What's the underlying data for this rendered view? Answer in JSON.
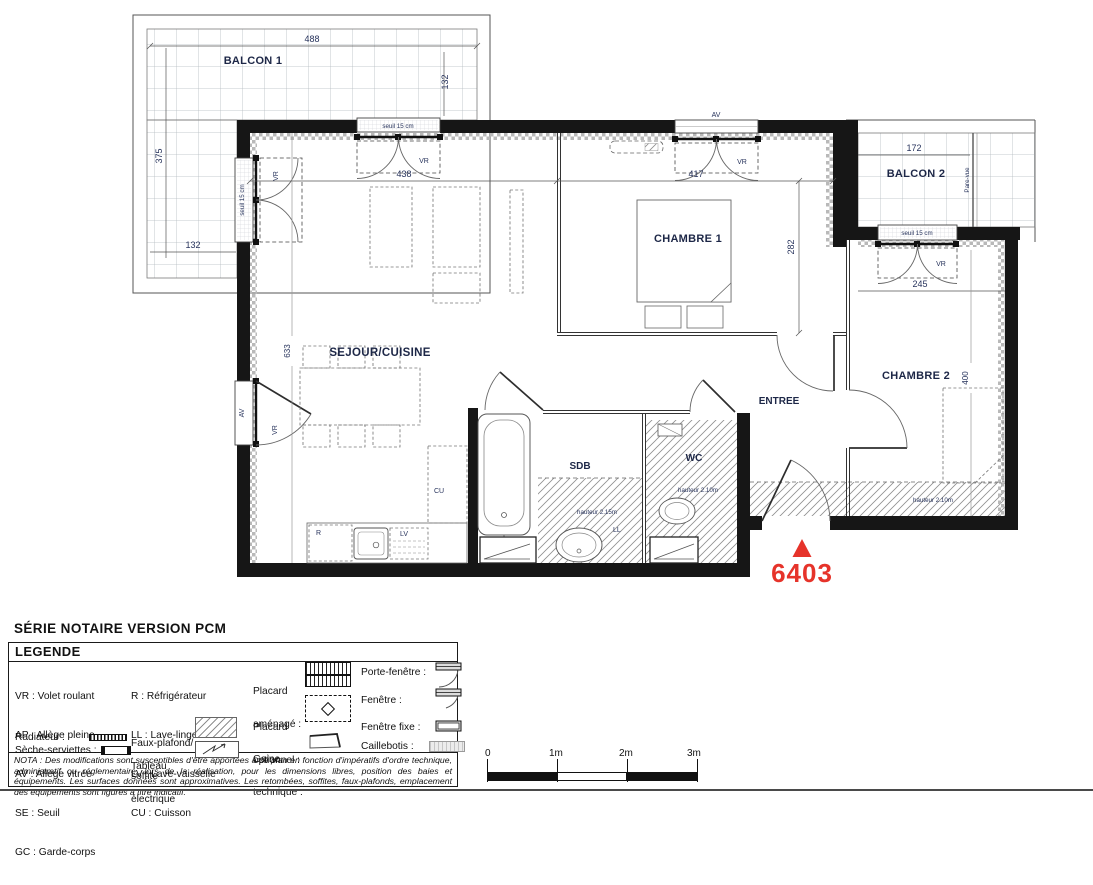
{
  "title": "SÉRIE NOTAIRE VERSION PCM",
  "plan": {
    "lot_number": "6403",
    "rooms": {
      "balcon1": "BALCON 1",
      "balcon2": "BALCON 2",
      "sejour": "SEJOUR/CUISINE",
      "chambre1": "CHAMBRE 1",
      "chambre2": "CHAMBRE 2",
      "entree": "ENTREE",
      "sdb": "SDB",
      "wc": "WC"
    },
    "dimensions": {
      "balcon1_width": "488",
      "balcon1_side": "132",
      "balcon1_left": "375",
      "balcon1_bottom": "132",
      "sejour_bay": "438",
      "sejour_depth": "633",
      "chambre1_width": "417",
      "chambre1_depth": "282",
      "balcon2_width": "172",
      "chambre2_bay": "245",
      "chambre2_depth": "400"
    },
    "annotations": {
      "seuil": "seuil 15 cm",
      "vr": "VR",
      "av": "AV",
      "parevue": "Pare-vue",
      "hauteur_sdb": "hauteur 2.15m",
      "hauteur_wc": "hauteur 2.10m",
      "hauteur_entree": "hauteur 2.10m",
      "refrigerateur": "R",
      "lave_linge": "LL",
      "lave_vaisselle": "LV",
      "cuisson": "CU"
    }
  },
  "legend": {
    "header": "LEGENDE",
    "abbreviations": [
      "VR : Volet roulant",
      "AP : Allège pleine",
      "AV : Allège vitrée",
      "SE : Seuil",
      "GC : Garde-corps"
    ],
    "appliances": [
      "R : Réfrigérateur",
      "LL : Lave-linge",
      "LV : Lave-vaisselle",
      "CU : Cuisson"
    ],
    "radiateur": "Radiateur :",
    "seche_serviettes": "Sèche-serviettes :",
    "faux_plafond_1": "Faux-plafond/",
    "faux_plafond_2": "soffite",
    "tableau_1": "Tableau",
    "tableau_2": "électrique",
    "placard_amenage_1": "Placard",
    "placard_amenage_2": "aménagé :",
    "placard_optionnel_1": "Placard",
    "placard_optionnel_2": "optionnel :",
    "gaine_1": "Gaine",
    "gaine_2": "technique :",
    "porte_fenetre": "Porte-fenêtre :",
    "fenetre": "Fenêtre :",
    "fenetre_fixe": "Fenêtre fixe :",
    "caillebotis": "Caillebotis :"
  },
  "nota": "NOTA : Des modifications sont susceptibles d'être apportées à ce plan en fonction d'impératifs d'ordre technique, administratif ou réglementaire, lors de la réalisation, pour les dimensions libres, position des baies et équipements. Les surfaces données sont approximatives. Les retombées, soffites, faux-plafonds, emplacement des équipements  sont figurés à titre indicatif.",
  "scale": {
    "t0": "0",
    "t1": "1m",
    "t2": "2m",
    "t3": "3m"
  },
  "colors": {
    "accent_red": "#e6332a",
    "wall_black": "#161616"
  }
}
